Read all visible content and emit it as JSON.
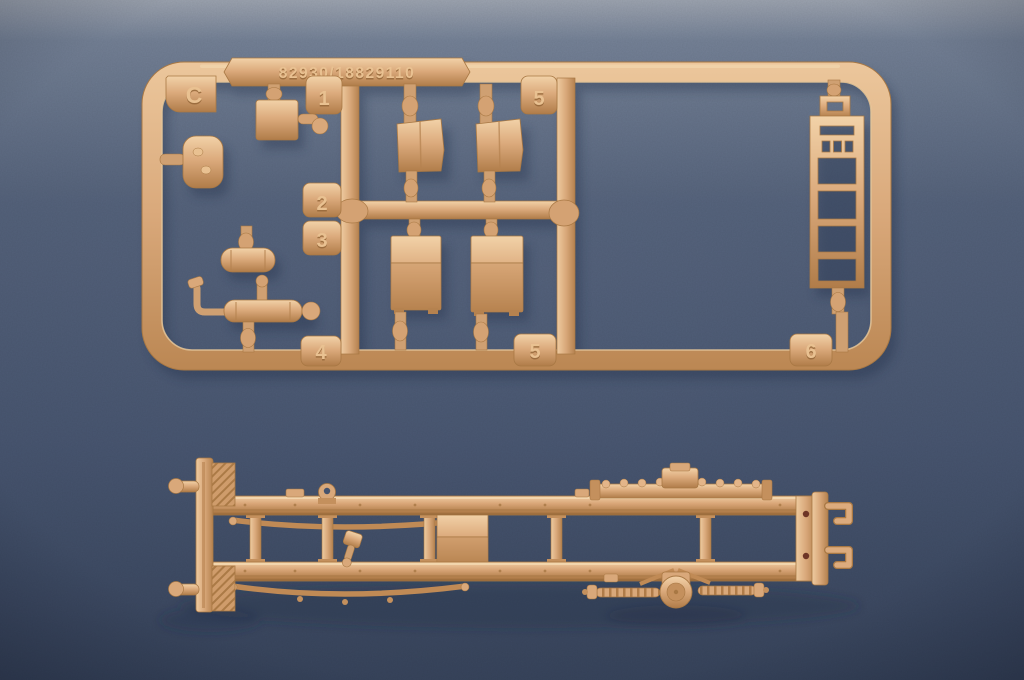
{
  "colors": {
    "background_top": "#9ba3b1",
    "background_mid": "#56647e",
    "background_bottom": "#3a475f",
    "plastic_base": "#d9a87a",
    "plastic_highlight": "#f2d2a8",
    "plastic_shadow": "#a87844",
    "emboss_light": "#e9c191",
    "emboss_dark": "#96683a",
    "hole_accent": "#6e3526"
  },
  "sprue": {
    "mold_code": "82930/18829110",
    "corner_letter": "C",
    "tabs": {
      "one": "1",
      "two": "2",
      "three": "3",
      "four": "4",
      "five_top": "5",
      "five_bottom": "5",
      "six": "6"
    }
  }
}
